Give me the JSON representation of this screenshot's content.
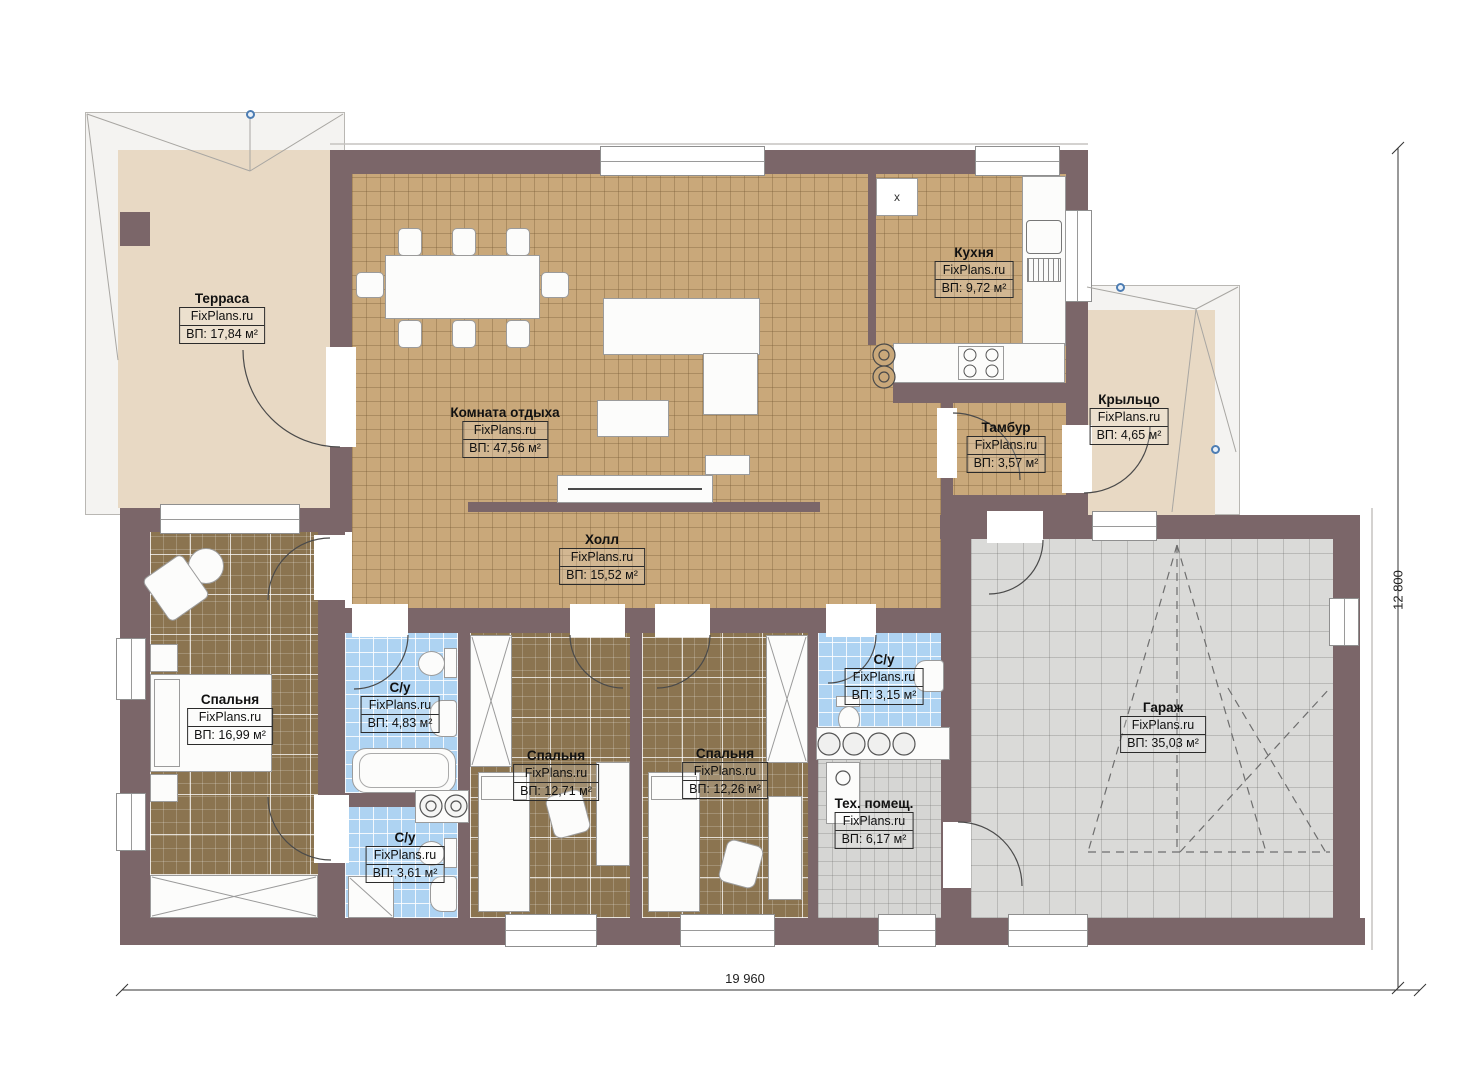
{
  "watermark": "FixPlans.ru",
  "rooms": {
    "terrace": {
      "name": "Терраса",
      "area": "ВП: 17,84 м²"
    },
    "lounge": {
      "name": "Комната отдыха",
      "area": "ВП: 47,56 м²"
    },
    "kitchen": {
      "name": "Кухня",
      "area": "ВП: 9,72 м²"
    },
    "vestibule": {
      "name": "Тамбур",
      "area": "ВП: 3,57 м²"
    },
    "porch": {
      "name": "Крыльцо",
      "area": "ВП: 4,65 м²"
    },
    "hall": {
      "name": "Холл",
      "area": "ВП: 15,52 м²"
    },
    "bedroom1": {
      "name": "Спальня",
      "area": "ВП: 16,99 м²"
    },
    "bath1": {
      "name": "С/у",
      "area": "ВП: 4,83 м²"
    },
    "bath2": {
      "name": "С/у",
      "area": "ВП: 3,61 м²"
    },
    "bedroom2": {
      "name": "Спальня",
      "area": "ВП: 12,71 м²"
    },
    "bedroom3": {
      "name": "Спальня",
      "area": "ВП: 12,26 м²"
    },
    "bath3": {
      "name": "С/у",
      "area": "ВП: 3,15 м²"
    },
    "utility": {
      "name": "Тех. помещ.",
      "area": "ВП: 6,17 м²"
    },
    "garage": {
      "name": "Гараж",
      "area": "ВП: 35,03 м²"
    }
  },
  "dimensions": {
    "width": "19 960",
    "height": "12 800"
  },
  "vent_label": "x",
  "colors": {
    "wall": "#7b6669",
    "floor_living": "#c9a87a",
    "floor_bedroom": "#8b7450",
    "floor_bath": "#aed3f2",
    "floor_garage": "#dadad8",
    "floor_terrace": "#e8d9c4",
    "marker_blue": "#4d7db3"
  }
}
